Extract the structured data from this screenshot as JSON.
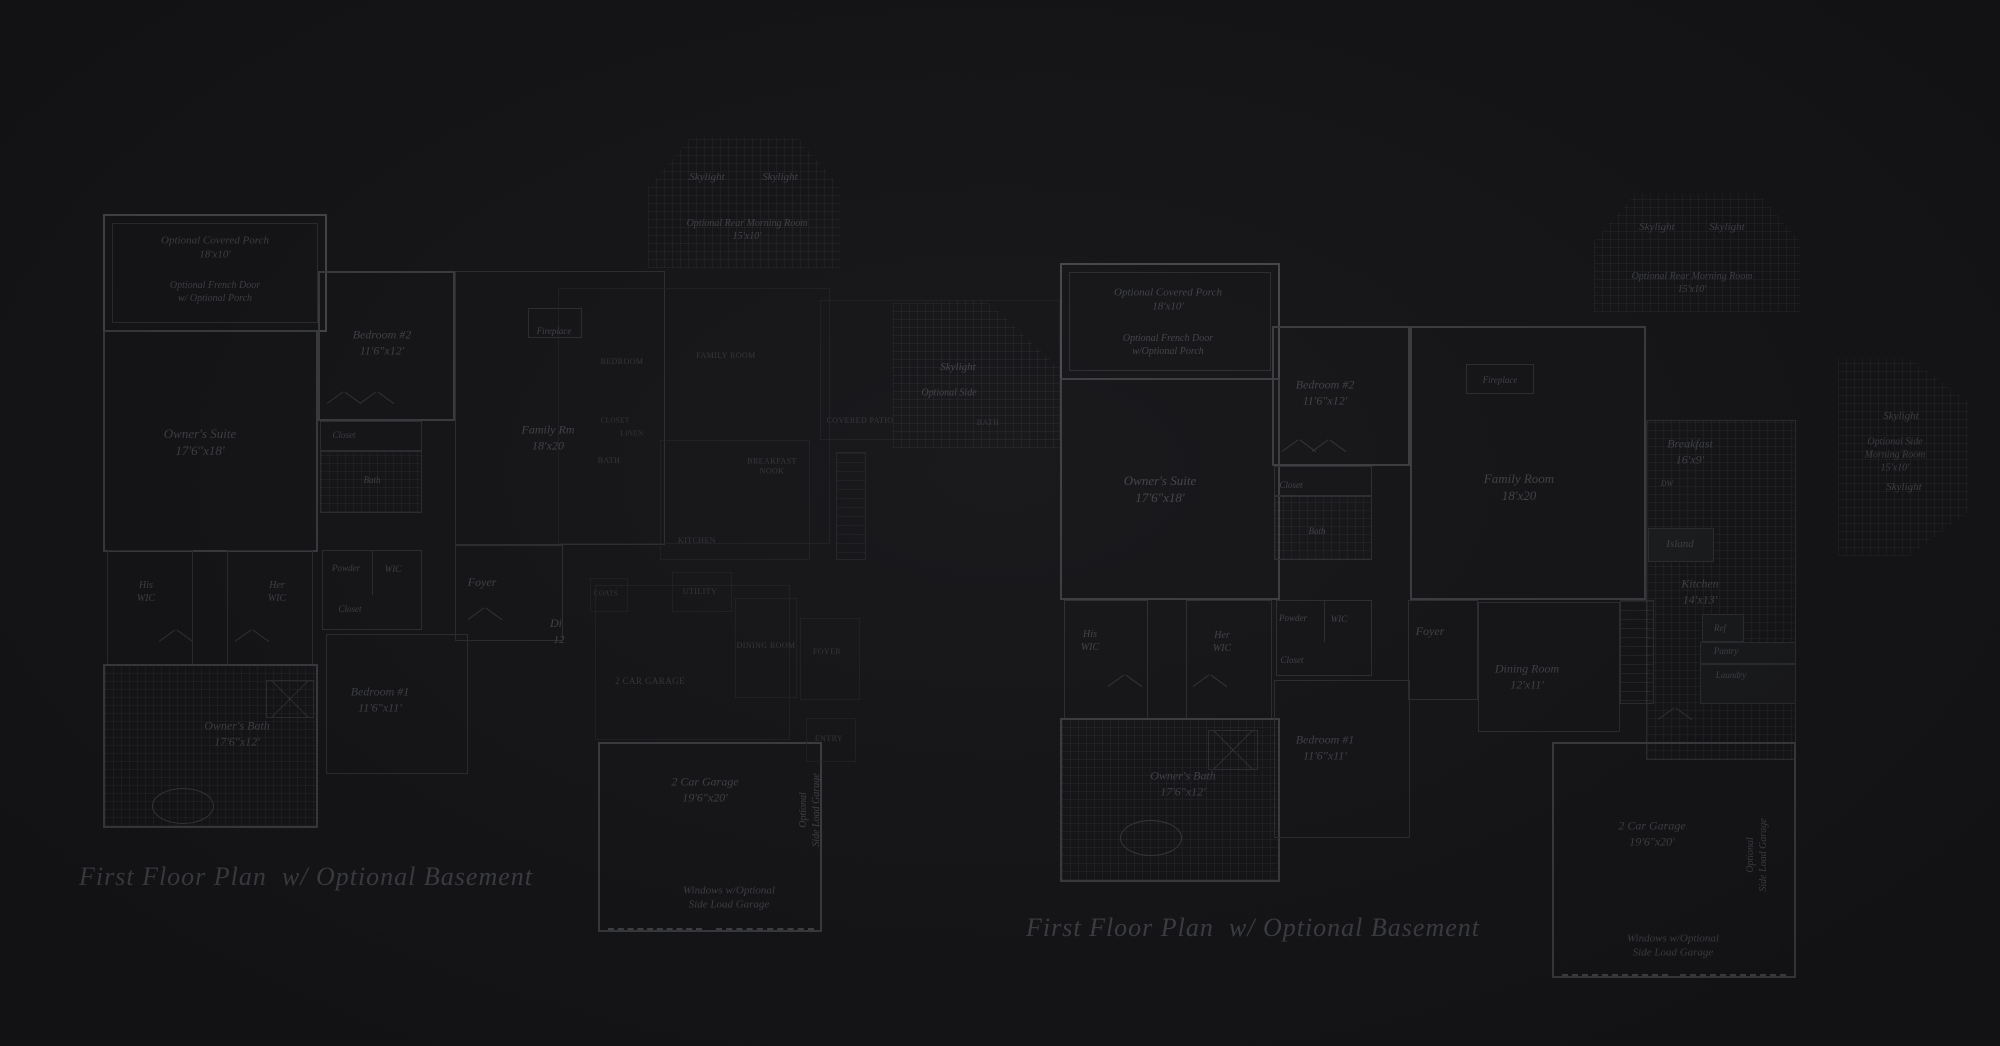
{
  "page": {
    "colors": {
      "background": "#17171a",
      "line": "#2e3033",
      "wall": "#3e4043",
      "text": "#45474c"
    }
  },
  "plans": [
    {
      "title": "First Floor Plan  w/ Optional Basement",
      "labels": [
        {
          "t": "Optional Covered Porch\n18'x10'",
          "x": 215,
          "y": 248,
          "fs": 11
        },
        {
          "t": "Optional French Door\nw/ Optional Porch",
          "x": 215,
          "y": 292,
          "fs": 10
        },
        {
          "t": "Owner's Suite\n17'6\"x18'",
          "x": 200,
          "y": 443,
          "fs": 13
        },
        {
          "t": "Bedroom #2\n11'6\"x12'",
          "x": 382,
          "y": 343,
          "fs": 12
        },
        {
          "t": "Closet",
          "x": 344,
          "y": 436,
          "fs": 9
        },
        {
          "t": "Bath",
          "x": 372,
          "y": 481,
          "fs": 9
        },
        {
          "t": "Fireplace",
          "x": 554,
          "y": 332,
          "fs": 9
        },
        {
          "t": "Family Rm\n18'x20",
          "x": 548,
          "y": 438,
          "fs": 12
        },
        {
          "t": "Skylight",
          "x": 707,
          "y": 177,
          "fs": 11
        },
        {
          "t": "Skylight",
          "x": 780,
          "y": 177,
          "fs": 11
        },
        {
          "t": "Optional Rear Morning Room\n15'x10'",
          "x": 747,
          "y": 230,
          "fs": 10
        },
        {
          "t": "Skylight",
          "x": 958,
          "y": 367,
          "fs": 11
        },
        {
          "t": "Optional Side",
          "x": 949,
          "y": 393,
          "fs": 10
        },
        {
          "t": "His\nWIC",
          "x": 146,
          "y": 592,
          "fs": 10
        },
        {
          "t": "Her\nWIC",
          "x": 277,
          "y": 592,
          "fs": 10
        },
        {
          "t": "Powder",
          "x": 346,
          "y": 569,
          "fs": 9
        },
        {
          "t": "WIC",
          "x": 393,
          "y": 570,
          "fs": 9
        },
        {
          "t": "Closet",
          "x": 350,
          "y": 610,
          "fs": 9
        },
        {
          "t": "Foyer",
          "x": 482,
          "y": 583,
          "fs": 12
        },
        {
          "t": "Di",
          "x": 556,
          "y": 624,
          "fs": 12
        },
        {
          "t": "12",
          "x": 559,
          "y": 640,
          "fs": 11
        },
        {
          "t": "Bedroom #1\n11'6\"x11'",
          "x": 380,
          "y": 700,
          "fs": 12
        },
        {
          "t": "Owner's Bath\n17'6\"x12'",
          "x": 237,
          "y": 734,
          "fs": 12
        },
        {
          "t": "2 Car Garage\n19'6\"x20'",
          "x": 705,
          "y": 790,
          "fs": 12
        },
        {
          "t": "Windows w/Optional\nSide Load Garage",
          "x": 729,
          "y": 898,
          "fs": 11
        },
        {
          "t": "Optional\nSide Load Garage",
          "x": 810,
          "y": 810,
          "fs": 10,
          "rot": -90
        },
        {
          "t": "BEDROOM",
          "x": 622,
          "y": 362,
          "fs": 8,
          "cap": 1
        },
        {
          "t": "FAMILY ROOM",
          "x": 726,
          "y": 356,
          "fs": 8,
          "cap": 1
        },
        {
          "t": "BREAKFAST\nNOOK",
          "x": 772,
          "y": 467,
          "fs": 8,
          "cap": 1
        },
        {
          "t": "KITCHEN",
          "x": 697,
          "y": 541,
          "fs": 8,
          "cap": 1
        },
        {
          "t": "COVERED PATIO",
          "x": 860,
          "y": 421,
          "fs": 8,
          "cap": 1
        },
        {
          "t": "BATH",
          "x": 988,
          "y": 423,
          "fs": 8,
          "cap": 1
        },
        {
          "t": "CLOSET",
          "x": 615,
          "y": 421,
          "fs": 7,
          "cap": 1
        },
        {
          "t": "LINEN",
          "x": 632,
          "y": 434,
          "fs": 7,
          "cap": 1
        },
        {
          "t": "BATH",
          "x": 609,
          "y": 461,
          "fs": 8,
          "cap": 1
        },
        {
          "t": "COATS",
          "x": 606,
          "y": 594,
          "fs": 7,
          "cap": 1
        },
        {
          "t": "UTILITY",
          "x": 700,
          "y": 592,
          "fs": 8,
          "cap": 1
        },
        {
          "t": "2 CAR GARAGE",
          "x": 650,
          "y": 682,
          "fs": 9,
          "cap": 1
        },
        {
          "t": "DINING ROOM",
          "x": 766,
          "y": 646,
          "fs": 8,
          "cap": 1
        },
        {
          "t": "FOYER",
          "x": 827,
          "y": 652,
          "fs": 8,
          "cap": 1
        },
        {
          "t": "ENTRY",
          "x": 829,
          "y": 739,
          "fs": 8,
          "cap": 1
        }
      ]
    },
    {
      "title": "First Floor Plan  w/ Optional Basement",
      "labels": [
        {
          "t": "Optional Covered Porch\n18'x10'",
          "x": 1168,
          "y": 300,
          "fs": 11
        },
        {
          "t": "Optional French Door\nw/Optional Porch",
          "x": 1168,
          "y": 345,
          "fs": 10
        },
        {
          "t": "Skylight",
          "x": 1657,
          "y": 227,
          "fs": 11
        },
        {
          "t": "Skylight",
          "x": 1727,
          "y": 227,
          "fs": 11
        },
        {
          "t": "Optional Rear Morning Room\n15'x10'",
          "x": 1692,
          "y": 283,
          "fs": 10
        },
        {
          "t": "Owner's Suite\n17'6\"x18'",
          "x": 1160,
          "y": 490,
          "fs": 13
        },
        {
          "t": "Bedroom #2\n11'6\"x12'",
          "x": 1325,
          "y": 393,
          "fs": 12
        },
        {
          "t": "Fireplace",
          "x": 1500,
          "y": 381,
          "fs": 9
        },
        {
          "t": "Family Room\n18'x20",
          "x": 1519,
          "y": 488,
          "fs": 13
        },
        {
          "t": "Breakfast\n16'x9'",
          "x": 1690,
          "y": 452,
          "fs": 12
        },
        {
          "t": "DW",
          "x": 1667,
          "y": 484,
          "fs": 8
        },
        {
          "t": "Island",
          "x": 1680,
          "y": 544,
          "fs": 11
        },
        {
          "t": "Kitchen\n14'x13'",
          "x": 1700,
          "y": 592,
          "fs": 12
        },
        {
          "t": "Ref",
          "x": 1720,
          "y": 629,
          "fs": 9
        },
        {
          "t": "Pantry",
          "x": 1726,
          "y": 652,
          "fs": 9
        },
        {
          "t": "Laundry",
          "x": 1731,
          "y": 676,
          "fs": 9
        },
        {
          "t": "Closet",
          "x": 1291,
          "y": 486,
          "fs": 9
        },
        {
          "t": "Bath",
          "x": 1317,
          "y": 532,
          "fs": 9
        },
        {
          "t": "His\nWIC",
          "x": 1090,
          "y": 641,
          "fs": 10
        },
        {
          "t": "Her\nWIC",
          "x": 1222,
          "y": 642,
          "fs": 10
        },
        {
          "t": "Powder",
          "x": 1293,
          "y": 619,
          "fs": 9
        },
        {
          "t": "WIC",
          "x": 1339,
          "y": 620,
          "fs": 9
        },
        {
          "t": "Closet",
          "x": 1292,
          "y": 661,
          "fs": 9
        },
        {
          "t": "Foyer",
          "x": 1430,
          "y": 632,
          "fs": 12
        },
        {
          "t": "Dining Room\n12'x11'",
          "x": 1527,
          "y": 677,
          "fs": 12
        },
        {
          "t": "Bedroom #1\n11'6\"x11'",
          "x": 1325,
          "y": 748,
          "fs": 12
        },
        {
          "t": "Owner's Bath\n17'6\"x12'",
          "x": 1183,
          "y": 784,
          "fs": 12
        },
        {
          "t": "2 Car Garage\n19'6\"x20'",
          "x": 1652,
          "y": 834,
          "fs": 12
        },
        {
          "t": "Windows w/Optional\nSide Load Garage",
          "x": 1673,
          "y": 946,
          "fs": 11
        },
        {
          "t": "Optional\nSide Load Garage",
          "x": 1757,
          "y": 855,
          "fs": 10,
          "rot": -90
        },
        {
          "t": "Skylight",
          "x": 1901,
          "y": 416,
          "fs": 11
        },
        {
          "t": "Optional Side\nMorning Room\n15'x10'",
          "x": 1895,
          "y": 455,
          "fs": 10
        },
        {
          "t": "Skylight",
          "x": 1904,
          "y": 487,
          "fs": 11
        }
      ]
    }
  ]
}
